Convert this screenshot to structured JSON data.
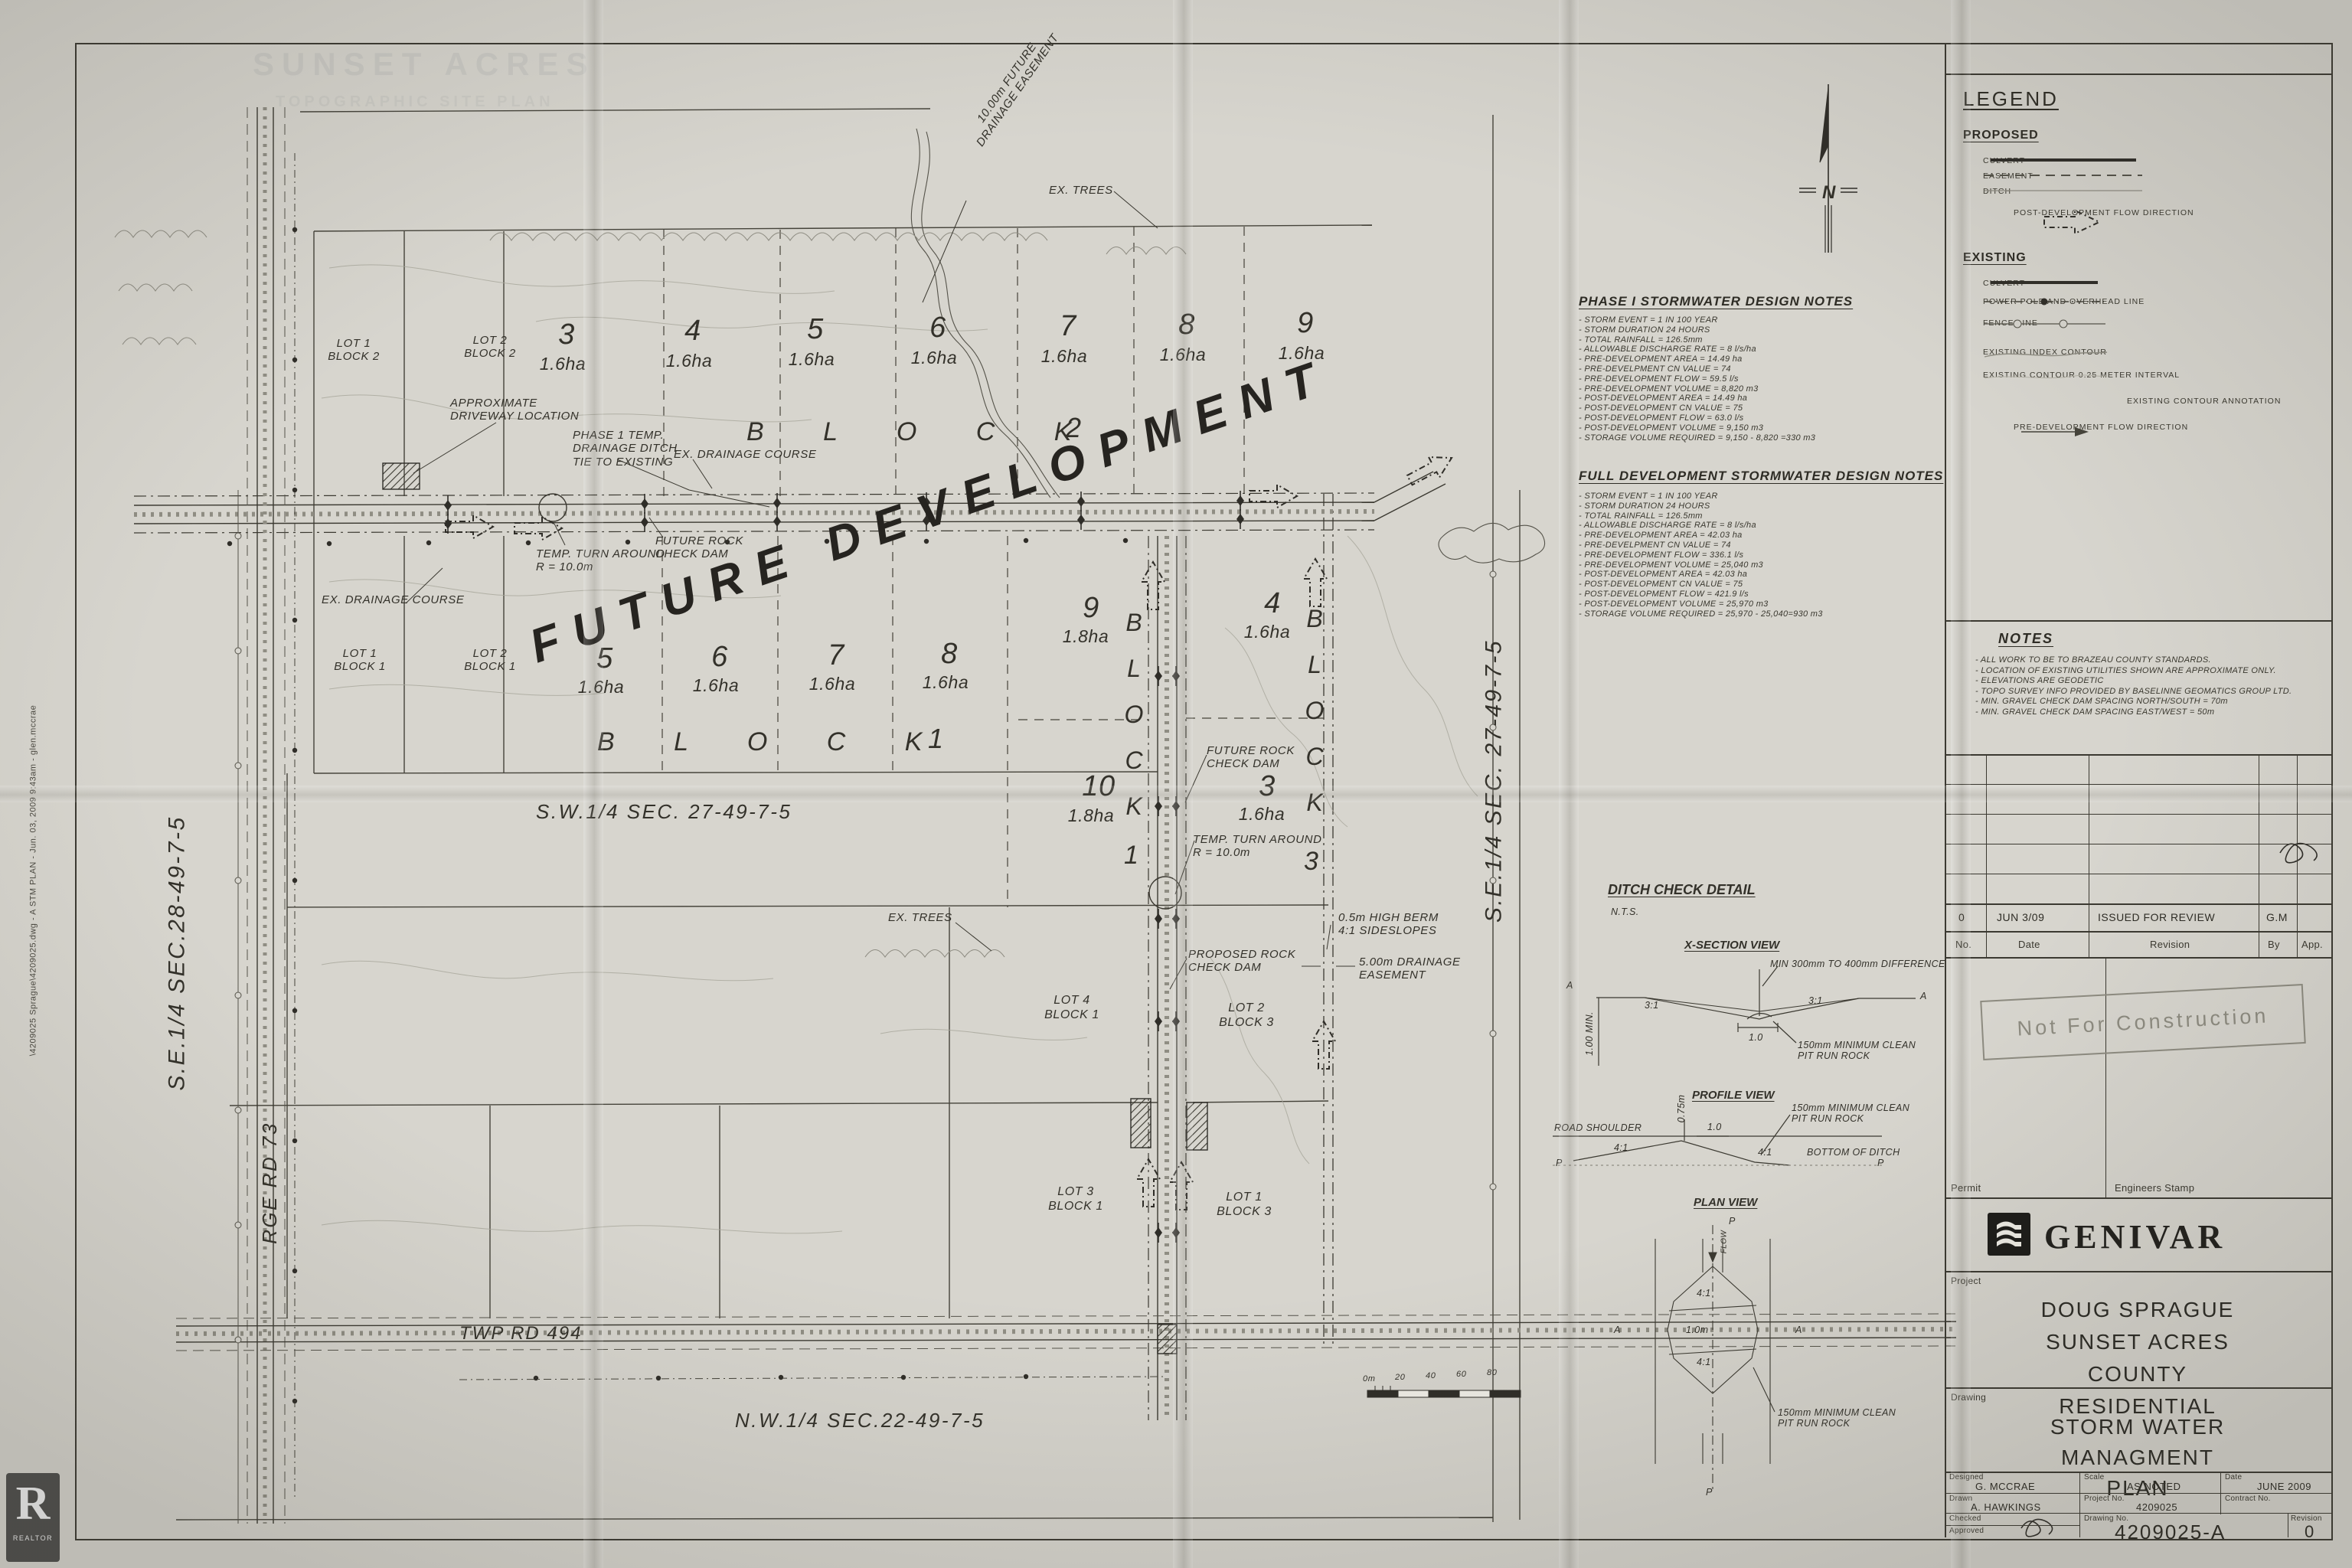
{
  "ann": {
    "future_dev": "FUTURE DEVELOPMENT",
    "fut_easement": "10.00m FUTURE\nDRAINAGE EASEMENT",
    "ex_trees": "EX. TREES",
    "approx_driveway": "APPROXIMATE\nDRIVEWAY LOCATION",
    "phase1_ditch": "PHASE 1 TEMP.\nDRAINAGE DITCH\nTIE TO EXISTING",
    "ex_drainage": "EX. DRAINAGE COURSE",
    "temp_turn": "TEMP. TURN AROUND\nR = 10.0m",
    "future_rock": "FUTURE ROCK\nCHECK DAM",
    "proposed_rock": "PROPOSED ROCK\nCHECK DAM",
    "berm": "0.5m HIGH BERM\n4:1 SIDESLOPES",
    "drain_ease": "5.00m DRAINAGE\nEASEMENT"
  },
  "lots": {
    "block_letters": "B L O C K",
    "block2_n": "2",
    "block1_n": "1",
    "vblock": "BLOCK",
    "vblock1_n": "1",
    "vblock3_n": "3",
    "row1": [
      {
        "n": "3",
        "a": "1.6ha"
      },
      {
        "n": "4",
        "a": "1.6ha"
      },
      {
        "n": "5",
        "a": "1.6ha"
      },
      {
        "n": "6",
        "a": "1.6ha"
      },
      {
        "n": "7",
        "a": "1.6ha"
      },
      {
        "n": "8",
        "a": "1.6ha"
      },
      {
        "n": "9",
        "a": "1.6ha"
      }
    ],
    "row2": [
      {
        "n": "5",
        "a": "1.6ha"
      },
      {
        "n": "6",
        "a": "1.6ha"
      },
      {
        "n": "7",
        "a": "1.6ha"
      },
      {
        "n": "8",
        "a": "1.6ha"
      }
    ],
    "lot9": {
      "n": "9",
      "a": "1.8ha"
    },
    "lot4": {
      "n": "4",
      "a": "1.6ha"
    },
    "lot10": {
      "n": "10",
      "a": "1.8ha"
    },
    "lot3": {
      "n": "3",
      "a": "1.6ha"
    },
    "named": {
      "l1b2": "LOT 1\nBLOCK 2",
      "l2b2": "LOT 2\nBLOCK 2",
      "l1b1": "LOT 1\nBLOCK 1",
      "l2b1": "LOT 2\nBLOCK 1",
      "l4b1": "LOT 4\nBLOCK 1",
      "l2b3": "LOT 2\nBLOCK 3",
      "l3b1": "LOT 3\nBLOCK 1",
      "l1b3": "LOT 1\nBLOCK 3"
    }
  },
  "sections": {
    "se28": "S.E.1/4  SEC.28-49-7-5",
    "rge73": "RGE RD 73",
    "sw27": "S.W.1/4  SEC. 27-49-7-5",
    "se27": "S.E.1/4  SEC. 27-49-7-5",
    "nw22": "N.W.1/4  SEC.22-49-7-5",
    "twp494": "TWP RD 494"
  },
  "scalebar": [
    "0m",
    "20",
    "40",
    "60",
    "80"
  ],
  "north_letter": "N",
  "notes_phase1": {
    "title": "PHASE I STORMWATER DESIGN NOTES",
    "items": "-  STORM EVENT = 1 IN 100 YEAR\n-  STORM DURATION 24 HOURS\n-  TOTAL RAINFALL = 126.5mm\n-  ALLOWABLE DISCHARGE RATE = 8 l/s/ha\n-  PRE-DEVELOPMENT AREA = 14.49 ha\n-  PRE-DEVELPMENT CN VALUE = 74\n-  PRE-DEVELOPMENT FLOW = 59.5 l/s\n-  PRE-DEVELOPMENT VOLUME = 8,820 m3\n-  POST-DEVELOPMENT AREA = 14.49 ha\n-  POST-DEVELOPMENT CN VALUE = 75\n-  POST-DEVELOPMENT FLOW = 63.0 l/s\n-  POST-DEVELOPMENT VOLUME = 9,150 m3\n-  STORAGE VOLUME REQUIRED = 9,150 - 8,820 =330 m3"
  },
  "notes_full": {
    "title": "FULL DEVELOPMENT STORMWATER DESIGN NOTES",
    "items": "-  STORM EVENT = 1 IN 100 YEAR\n-  STORM DURATION 24 HOURS\n-  TOTAL RAINFALL = 126.5mm\n-  ALLOWABLE DISCHARGE RATE = 8 l/s/ha\n-  PRE-DEVELOPMENT AREA = 42.03 ha\n-  PRE-DEVELPMENT CN VALUE = 74\n-  PRE-DEVELOPMENT FLOW = 336.1 l/s\n-  PRE-DEVELOPMENT VOLUME = 25,040 m3\n-  POST-DEVELOPMENT AREA = 42.03 ha\n-  POST-DEVELOPMENT CN VALUE = 75\n-  POST-DEVELOPMENT FLOW = 421.9 l/s\n-  POST-DEVELOPMENT VOLUME = 25,970 m3\n-  STORAGE VOLUME REQUIRED = 25,970 - 25,040=930 m3"
  },
  "site_notes": {
    "title": "NOTES",
    "items": "-  ALL WORK TO BE TO BRAZEAU COUNTY STANDARDS.\n-  LOCATION OF EXISTING UTILITIES SHOWN ARE APPROXIMATE ONLY.\n-  ELEVATIONS ARE GEODETIC\n-  TOPO SURVEY INFO PROVIDED BY BASELINNE GEOMATICS GROUP LTD.\n-  MIN. GRAVEL CHECK DAM SPACING NORTH/SOUTH = 70m\n-  MIN. GRAVEL CHECK DAM SPACING EAST/WEST = 50m"
  },
  "detail": {
    "title": "DITCH CHECK DETAIL",
    "nts": "N.T.S.",
    "xs_title": "X-SECTION VIEW",
    "xs_diff": "MIN 300mm TO 400mm DIFFERENCE",
    "s31": "3:1",
    "s41": "4:1",
    "d10": "1.0",
    "d10m": "1.0m",
    "d075": "0.75m",
    "rock": "150mm MINIMUM CLEAN\nPIT RUN ROCK",
    "min100": "1.00 MIN.",
    "a": "A",
    "p": "P",
    "pf_title": "PROFILE VIEW",
    "road_shoulder": "ROAD SHOULDER",
    "bottom": "BOTTOM OF DITCH",
    "pv_title": "PLAN VIEW",
    "flow": "FLOW"
  },
  "legend": {
    "title": "LEGEND",
    "proposed": "PROPOSED",
    "p_culvert": "CULVERT",
    "p_easement": "EASEMENT",
    "p_ditch": "DITCH",
    "p_flow": "POST-DEVELOPMENT FLOW DIRECTION",
    "existing": "EXISTING",
    "e_culvert": "CULVERT",
    "e_power": "POWER POLE AND OVERHEAD LINE",
    "e_fence": "FENCE LINE",
    "e_index": "EXISTING INDEX CONTOUR",
    "e_interval": "EXISTING CONTOUR 0.25 METER INTERVAL",
    "e_annotation": "EXISTING CONTOUR ANNOTATION",
    "e_flow": "PRE-DEVELOPMENT FLOW DIRECTION"
  },
  "tb": {
    "rev_no": "0",
    "rev_date": "JUN 3/09",
    "rev_desc": "ISSUED FOR REVIEW",
    "rev_by": "G.M",
    "h_no": "No.",
    "h_date": "Date",
    "h_rev": "Revision",
    "h_by": "By",
    "h_app": "App.",
    "stamp": "Not For Construction",
    "permit": "Permit",
    "eng_stamp": "Engineers Stamp",
    "company": "GENIVAR",
    "project_label": "Project",
    "project": "DOUG SPRAGUE\nSUNSET ACRES\nCOUNTY RESIDENTIAL",
    "drawing_label": "Drawing",
    "drawing": "STORM WATER\nMANAGMENT PLAN",
    "designed_l": "Designed",
    "designed": "G. MCCRAE",
    "scale_l": "Scale",
    "scale": "AS NOTED",
    "date_l": "Date",
    "date": "JUNE 2009",
    "drawn_l": "Drawn",
    "drawn": "A. HAWKINGS",
    "projno_l": "Project No.",
    "projno": "4209025",
    "contract_l": "Contract No.",
    "checked_l": "Checked",
    "approved_l": "Approved",
    "dwgno_l": "Drawing No.",
    "dwgno": "4209025-A",
    "rev_l": "Revision",
    "rev": "0"
  },
  "margin": {
    "file_info": "\\4209025 Sprague\\4209025.dwg  -  A STM PLAN  -  Jun. 03, 2009 9:43am  -  glen.mccrae",
    "realtor_r": "R",
    "realtor": "REALTOR",
    "ghost1": "SUNSET ACRES",
    "ghost2": "TOPOGRAPHIC SITE PLAN"
  }
}
